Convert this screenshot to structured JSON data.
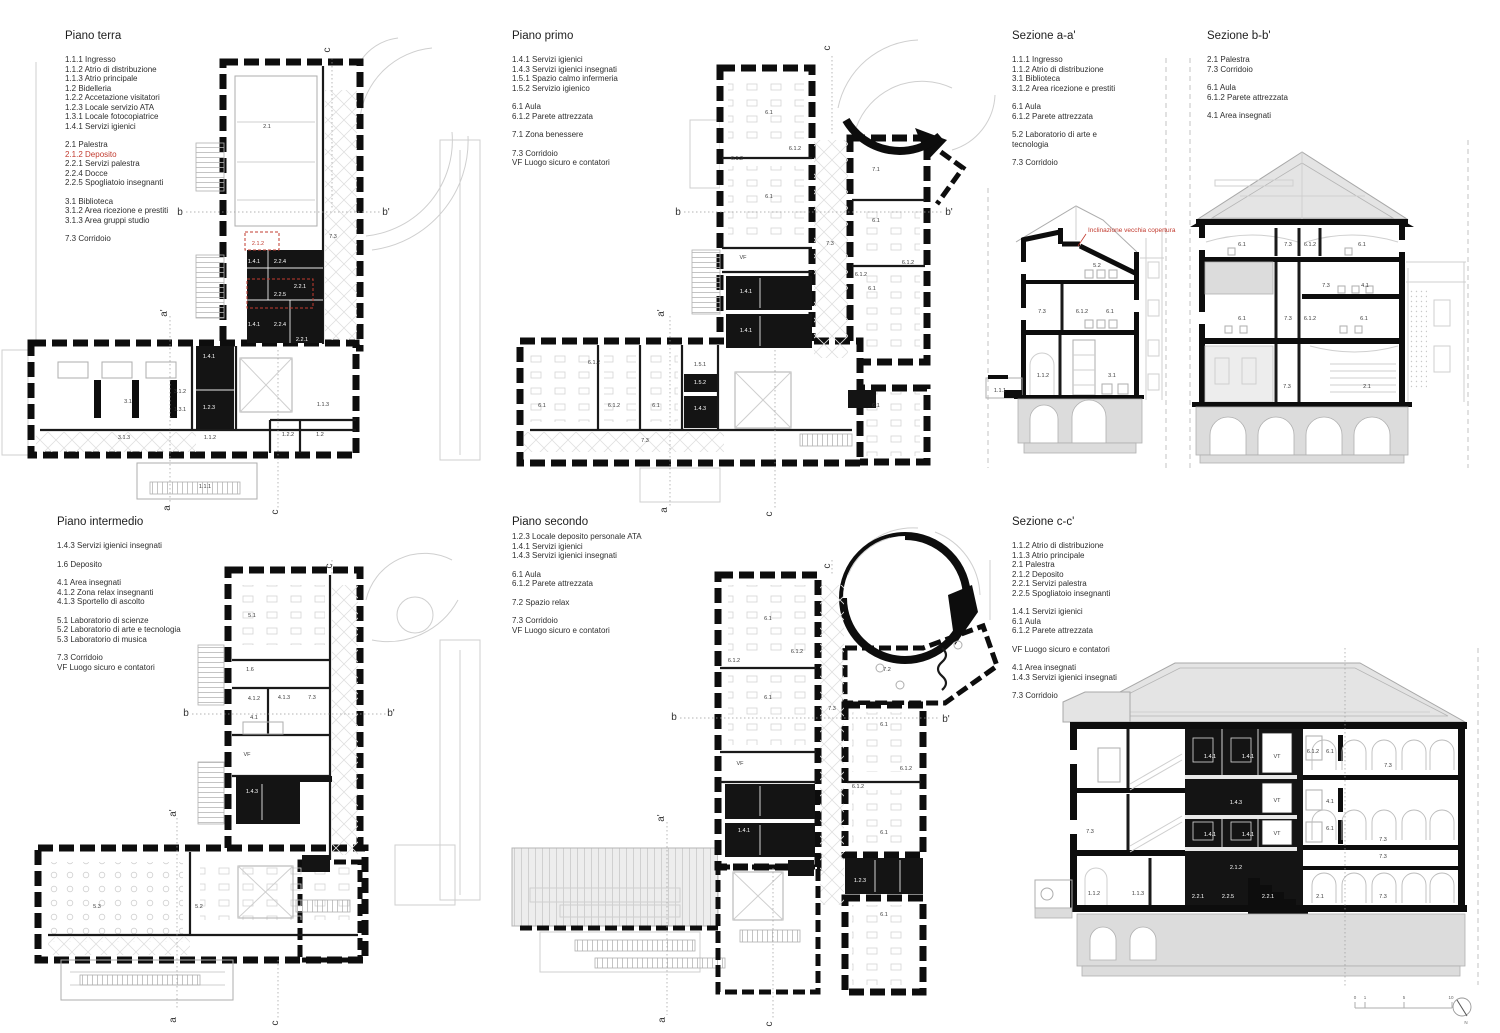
{
  "sheet": {
    "background": "#ffffff",
    "accent_red": "#c23b2f",
    "ink": "#0d0d0d"
  },
  "legends": {
    "pt": {
      "title": "Piano terra",
      "groups": [
        [
          "1.1.1 Ingresso",
          "1.1.2 Atrio di distribuzione",
          "1.1.3 Atrio principale",
          "1.2 Bidelleria",
          "1.2.2 Accetazione visitatori",
          "1.2.3 Locale servizio ATA",
          "1.3.1 Locale fotocopiatrice",
          "1.4.1 Servizi igienici"
        ],
        [
          "2.1 Palestra",
          {
            "t": "2.1.2 Deposito",
            "red": true
          },
          "2.2.1 Servizi palestra",
          "2.2.4 Docce",
          "2.2.5 Spogliatoio insegnanti"
        ],
        [
          "3.1 Biblioteca",
          "3.1.2 Area ricezione e prestiti",
          "3.1.3 Area gruppi studio"
        ],
        [
          "7.3 Corridoio"
        ]
      ]
    },
    "pp": {
      "title": "Piano primo",
      "groups": [
        [
          "1.4.1 Servizi igienici",
          "1.4.3 Servizi igienici insegnati",
          "1.5.1 Spazio calmo infermeria",
          "1.5.2 Servizio igienico"
        ],
        [
          "6.1 Aula",
          "6.1.2 Parete attrezzata"
        ],
        [
          "7.1 Zona benessere"
        ],
        [
          "7.3 Corridoio",
          "VF Luogo sicuro e contatori"
        ]
      ]
    },
    "sa": {
      "title": "Sezione a-a'",
      "groups": [
        [
          "1.1.1 Ingresso",
          "1.1.2 Atrio di distribuzione",
          "3.1 Biblioteca",
          "3.1.2 Area ricezione e prestiti"
        ],
        [
          "6.1 Aula",
          "6.1.2 Parete attrezzata"
        ],
        [
          "5.2 Laboratorio di arte e",
          "tecnologia"
        ],
        [
          "7.3 Corridoio"
        ]
      ]
    },
    "sb": {
      "title": "Sezione b-b'",
      "groups": [
        [
          "2.1 Palestra",
          "7.3 Corridoio"
        ],
        [
          "6.1 Aula",
          "6.1.2 Parete attrezzata"
        ],
        [
          "4.1 Area insegnati"
        ]
      ]
    },
    "pi": {
      "title": "Piano intermedio",
      "groups": [
        [
          "1.4.3 Servizi igienici insegnati"
        ],
        [
          "1.6 Deposito"
        ],
        [
          "4.1 Area insegnati",
          "4.1.2 Zona relax insegnanti",
          "4.1.3 Sportello di ascolto"
        ],
        [
          "5.1 Laboratorio di scienze",
          "5.2 Laboratorio di arte e tecnologia",
          "5.3 Laboratorio di musica"
        ],
        [
          "7.3 Corridoio",
          "VF Luogo sicuro e contatori"
        ]
      ]
    },
    "ps": {
      "title": "Piano secondo",
      "groups": [
        [
          "1.2.3 Locale deposito personale ATA",
          "1.4.1 Servizi igienici",
          "1.4.3 Servizi igienici insegnati"
        ],
        [
          "6.1 Aula",
          "6.1.2 Parete attrezzata"
        ],
        [
          "7.2 Spazio relax"
        ],
        [
          "7.3 Corridoio",
          "VF Luogo sicuro e contatori"
        ]
      ]
    },
    "sc": {
      "title": "Sezione c-c'",
      "groups": [
        [
          "1.1.2 Atrio di distribuzione",
          "1.1.3 Atrio principale",
          "2.1 Palestra",
          "2.1.2 Deposito",
          "2.2.1 Servizi palestra",
          "2.2.5 Spogliatoio insegnanti"
        ],
        [
          "1.4.1 Servizi igienici",
          "6.1 Aula",
          "6.1.2 Parete attrezzata"
        ],
        [
          "VF Luogo sicuro e contatori"
        ],
        [
          "4.1 Area insegnati",
          "1.4.3 Servizi igienici insegnati"
        ],
        [
          "7.3 Corridoio"
        ]
      ]
    }
  },
  "drawings": {
    "pt": {
      "name": "Piano terra plan",
      "labels": [
        {
          "t": "2.1",
          "x": 267,
          "y": 128
        },
        {
          "t": "7.3",
          "x": 333,
          "y": 238
        },
        {
          "t": "2.1.2",
          "x": 258,
          "y": 245,
          "cls": "red"
        },
        {
          "t": "1.4.1",
          "x": 254,
          "y": 263,
          "cls": "w"
        },
        {
          "t": "2.2.4",
          "x": 280,
          "y": 263,
          "cls": "w"
        },
        {
          "t": "2.2.1",
          "x": 300,
          "y": 288,
          "cls": "w"
        },
        {
          "t": "2.2.5",
          "x": 280,
          "y": 296,
          "cls": "w"
        },
        {
          "t": "1.4.1",
          "x": 254,
          "y": 326,
          "cls": "w"
        },
        {
          "t": "2.2.4",
          "x": 280,
          "y": 326,
          "cls": "w"
        },
        {
          "t": "2.2.1",
          "x": 302,
          "y": 341,
          "cls": "w"
        },
        {
          "t": "1.4.1",
          "x": 209,
          "y": 358,
          "cls": "w"
        },
        {
          "t": "1.2.3",
          "x": 209,
          "y": 409,
          "cls": "w"
        },
        {
          "t": "3.1",
          "x": 128,
          "y": 403
        },
        {
          "t": "3.1.2",
          "x": 180,
          "y": 393
        },
        {
          "t": "1.3.1",
          "x": 180,
          "y": 411
        },
        {
          "t": "3.1.3",
          "x": 124,
          "y": 439
        },
        {
          "t": "1.1.2",
          "x": 210,
          "y": 439
        },
        {
          "t": "1.1.3",
          "x": 323,
          "y": 406
        },
        {
          "t": "1.2.2",
          "x": 288,
          "y": 436
        },
        {
          "t": "1.2",
          "x": 320,
          "y": 436
        },
        {
          "t": "1.1.1",
          "x": 205,
          "y": 488
        },
        {
          "t": "b",
          "x": 180,
          "y": 215,
          "cls": "m"
        },
        {
          "t": "b'",
          "x": 386,
          "y": 215,
          "cls": "m"
        },
        {
          "t": "a'",
          "x": 167,
          "y": 313,
          "cls": "m",
          "rot": -90
        },
        {
          "t": "c",
          "x": 330,
          "y": 50,
          "cls": "m",
          "rot": -90
        },
        {
          "t": "a",
          "x": 170,
          "y": 508,
          "cls": "m",
          "rot": -90
        },
        {
          "t": "c",
          "x": 278,
          "y": 512,
          "cls": "m",
          "rot": -90
        }
      ]
    },
    "pp": {
      "name": "Piano primo plan",
      "labels": [
        {
          "t": "6.1",
          "x": 769,
          "y": 114
        },
        {
          "t": "6.1.2",
          "x": 795,
          "y": 150
        },
        {
          "t": "6.1.2",
          "x": 737,
          "y": 160
        },
        {
          "t": "6.1",
          "x": 769,
          "y": 198
        },
        {
          "t": "7.3",
          "x": 830,
          "y": 245
        },
        {
          "t": "VF",
          "x": 743,
          "y": 259
        },
        {
          "t": "1.4.1",
          "x": 746,
          "y": 293,
          "cls": "w"
        },
        {
          "t": "1.4.1",
          "x": 746,
          "y": 332,
          "cls": "w"
        },
        {
          "t": "7.1",
          "x": 876,
          "y": 171
        },
        {
          "t": "6.1",
          "x": 876,
          "y": 222
        },
        {
          "t": "6.1.2",
          "x": 908,
          "y": 264
        },
        {
          "t": "6.1.2",
          "x": 861,
          "y": 276
        },
        {
          "t": "6.1",
          "x": 872,
          "y": 290
        },
        {
          "t": "6.1",
          "x": 876,
          "y": 407
        },
        {
          "t": "6.1.2",
          "x": 594,
          "y": 364
        },
        {
          "t": "1.5.1",
          "x": 700,
          "y": 366
        },
        {
          "t": "1.5.2",
          "x": 700,
          "y": 384,
          "cls": "w"
        },
        {
          "t": "1.4.3",
          "x": 700,
          "y": 410,
          "cls": "w"
        },
        {
          "t": "6.1",
          "x": 542,
          "y": 407
        },
        {
          "t": "6.1.2",
          "x": 614,
          "y": 407
        },
        {
          "t": "6.1",
          "x": 656,
          "y": 407
        },
        {
          "t": "7.3",
          "x": 645,
          "y": 442
        },
        {
          "t": "b",
          "x": 678,
          "y": 215,
          "cls": "m"
        },
        {
          "t": "b'",
          "x": 949,
          "y": 215,
          "cls": "m"
        },
        {
          "t": "a'",
          "x": 664,
          "y": 313,
          "cls": "m",
          "rot": -90
        },
        {
          "t": "c",
          "x": 830,
          "y": 48,
          "cls": "m",
          "rot": -90
        },
        {
          "t": "a",
          "x": 667,
          "y": 510,
          "cls": "m",
          "rot": -90
        },
        {
          "t": "c",
          "x": 772,
          "y": 514,
          "cls": "m",
          "rot": -90
        }
      ]
    },
    "pi": {
      "name": "Piano intermedio plan",
      "labels": [
        {
          "t": "5.1",
          "x": 252,
          "y": 617
        },
        {
          "t": "1.6",
          "x": 250,
          "y": 671
        },
        {
          "t": "4.1.2",
          "x": 254,
          "y": 700
        },
        {
          "t": "4.1.3",
          "x": 284,
          "y": 699
        },
        {
          "t": "7.3",
          "x": 312,
          "y": 699
        },
        {
          "t": "4.1",
          "x": 254,
          "y": 719
        },
        {
          "t": "VF",
          "x": 247,
          "y": 756
        },
        {
          "t": "1.4.3",
          "x": 252,
          "y": 793,
          "cls": "w"
        },
        {
          "t": "5.3",
          "x": 97,
          "y": 908
        },
        {
          "t": "5.2",
          "x": 199,
          "y": 908
        },
        {
          "t": "b",
          "x": 186,
          "y": 716,
          "cls": "m"
        },
        {
          "t": "b'",
          "x": 391,
          "y": 716,
          "cls": "m"
        },
        {
          "t": "a'",
          "x": 176,
          "y": 813,
          "cls": "m",
          "rot": -90
        },
        {
          "t": "c",
          "x": 332,
          "y": 566,
          "cls": "m",
          "rot": -90
        },
        {
          "t": "a",
          "x": 176,
          "y": 1020,
          "cls": "m",
          "rot": -90
        },
        {
          "t": "c",
          "x": 278,
          "y": 1023,
          "cls": "m",
          "rot": -90
        }
      ]
    },
    "ps": {
      "name": "Piano secondo plan",
      "labels": [
        {
          "t": "6.1",
          "x": 768,
          "y": 620
        },
        {
          "t": "6.1.2",
          "x": 797,
          "y": 653
        },
        {
          "t": "6.1.2",
          "x": 734,
          "y": 662
        },
        {
          "t": "6.1",
          "x": 768,
          "y": 699
        },
        {
          "t": "7.3",
          "x": 832,
          "y": 710
        },
        {
          "t": "7.2",
          "x": 887,
          "y": 671
        },
        {
          "t": "6.1",
          "x": 884,
          "y": 726
        },
        {
          "t": "VF",
          "x": 740,
          "y": 765
        },
        {
          "t": "6.1.2",
          "x": 906,
          "y": 770
        },
        {
          "t": "6.1.2",
          "x": 858,
          "y": 788
        },
        {
          "t": "1.4.1",
          "x": 744,
          "y": 832,
          "cls": "w"
        },
        {
          "t": "6.1",
          "x": 884,
          "y": 834
        },
        {
          "t": "1.2.3",
          "x": 860,
          "y": 882,
          "cls": "w"
        },
        {
          "t": "6.1",
          "x": 884,
          "y": 916
        },
        {
          "t": "b",
          "x": 674,
          "y": 720,
          "cls": "m"
        },
        {
          "t": "b'",
          "x": 946,
          "y": 722,
          "cls": "m"
        },
        {
          "t": "a'",
          "x": 664,
          "y": 818,
          "cls": "m",
          "rot": -90
        },
        {
          "t": "c",
          "x": 830,
          "y": 566,
          "cls": "m",
          "rot": -90
        },
        {
          "t": "a",
          "x": 665,
          "y": 1020,
          "cls": "m",
          "rot": -90
        },
        {
          "t": "c",
          "x": 772,
          "y": 1024,
          "cls": "m",
          "rot": -90
        }
      ]
    },
    "sa": {
      "name": "Sezione a-a' drawing",
      "labels": [
        {
          "t": "Inclinazione vecchia copertura",
          "x": 1088,
          "y": 232,
          "cls": "redsm"
        },
        {
          "t": "5.2",
          "x": 1097,
          "y": 267
        },
        {
          "t": "7.3",
          "x": 1042,
          "y": 313
        },
        {
          "t": "6.1.2",
          "x": 1082,
          "y": 313
        },
        {
          "t": "6.1",
          "x": 1110,
          "y": 313
        },
        {
          "t": "1.1.2",
          "x": 1043,
          "y": 377
        },
        {
          "t": "3.1",
          "x": 1112,
          "y": 377
        },
        {
          "t": "1.1.1",
          "x": 1000,
          "y": 392
        }
      ]
    },
    "sb": {
      "name": "Sezione b-b' drawing",
      "labels": [
        {
          "t": "6.1",
          "x": 1242,
          "y": 246
        },
        {
          "t": "7.3",
          "x": 1288,
          "y": 246
        },
        {
          "t": "6.1.2",
          "x": 1310,
          "y": 246
        },
        {
          "t": "6.1",
          "x": 1362,
          "y": 246
        },
        {
          "t": "7.3",
          "x": 1326,
          "y": 287
        },
        {
          "t": "4.1",
          "x": 1365,
          "y": 287
        },
        {
          "t": "6.1",
          "x": 1242,
          "y": 320
        },
        {
          "t": "7.3",
          "x": 1288,
          "y": 320
        },
        {
          "t": "6.1.2",
          "x": 1310,
          "y": 320
        },
        {
          "t": "6.1",
          "x": 1364,
          "y": 320
        },
        {
          "t": "7.3",
          "x": 1287,
          "y": 388
        },
        {
          "t": "2.1",
          "x": 1367,
          "y": 388
        }
      ]
    },
    "sc": {
      "name": "Sezione c-c' drawing",
      "labels": [
        {
          "t": "1.4.1",
          "x": 1210,
          "y": 758,
          "cls": "w"
        },
        {
          "t": "1.4.1",
          "x": 1248,
          "y": 758,
          "cls": "w"
        },
        {
          "t": "VT",
          "x": 1277,
          "y": 758
        },
        {
          "t": "6.1.2",
          "x": 1313,
          "y": 753
        },
        {
          "t": "6.1",
          "x": 1330,
          "y": 753
        },
        {
          "t": "7.3",
          "x": 1388,
          "y": 767
        },
        {
          "t": "1.4.3",
          "x": 1236,
          "y": 804,
          "cls": "w"
        },
        {
          "t": "VT",
          "x": 1277,
          "y": 802
        },
        {
          "t": "4.1",
          "x": 1330,
          "y": 803
        },
        {
          "t": "1.4.1",
          "x": 1210,
          "y": 836,
          "cls": "w"
        },
        {
          "t": "1.4.1",
          "x": 1248,
          "y": 836,
          "cls": "w"
        },
        {
          "t": "VT",
          "x": 1277,
          "y": 835
        },
        {
          "t": "6.1",
          "x": 1330,
          "y": 830
        },
        {
          "t": "7.3",
          "x": 1090,
          "y": 833
        },
        {
          "t": "7.3",
          "x": 1383,
          "y": 841
        },
        {
          "t": "7.3",
          "x": 1383,
          "y": 858
        },
        {
          "t": "2.1.2",
          "x": 1236,
          "y": 869,
          "cls": "w"
        },
        {
          "t": "1.1.2",
          "x": 1094,
          "y": 895
        },
        {
          "t": "1.1.3",
          "x": 1138,
          "y": 895
        },
        {
          "t": "2.2.1",
          "x": 1198,
          "y": 898,
          "cls": "w"
        },
        {
          "t": "2.2.5",
          "x": 1228,
          "y": 898,
          "cls": "w"
        },
        {
          "t": "2.2.1",
          "x": 1268,
          "y": 898,
          "cls": "w"
        },
        {
          "t": "2.1",
          "x": 1320,
          "y": 898
        },
        {
          "t": "7.3",
          "x": 1383,
          "y": 898
        }
      ]
    },
    "misc": {
      "name": "Scale bar and north arrow",
      "labels": [
        {
          "t": "0",
          "x": 1355,
          "y": 999,
          "cls": "t"
        },
        {
          "t": "1",
          "x": 1365,
          "y": 999,
          "cls": "t"
        },
        {
          "t": "5",
          "x": 1404,
          "y": 999,
          "cls": "t"
        },
        {
          "t": "10",
          "x": 1451,
          "y": 999,
          "cls": "t"
        },
        {
          "t": "N",
          "x": 1466,
          "y": 1024,
          "cls": "t"
        }
      ]
    }
  }
}
